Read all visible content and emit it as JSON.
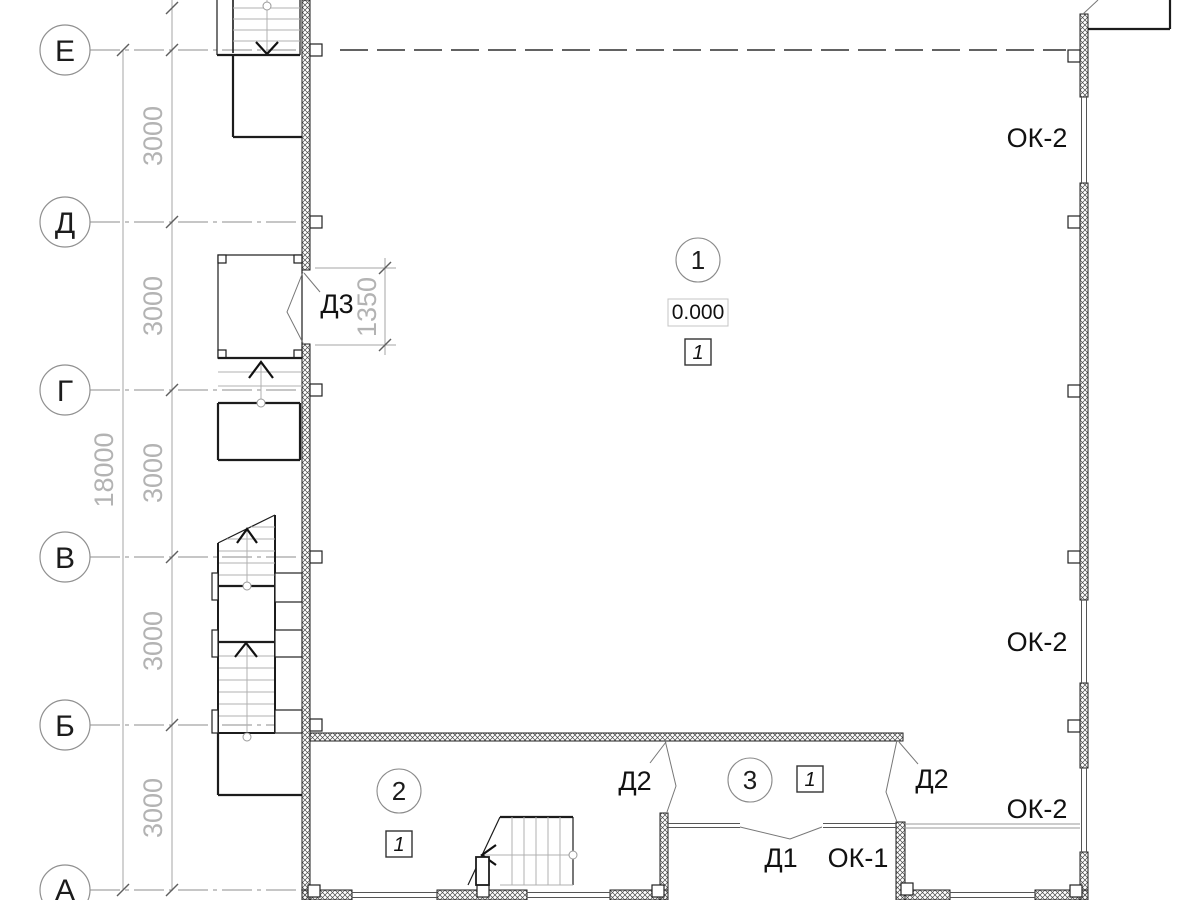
{
  "drawing": {
    "type": "architectural-floor-plan",
    "axes": {
      "e": "Е",
      "d": "Д",
      "g": "Г",
      "v": "В",
      "b": "Б",
      "a": "А"
    },
    "dims": {
      "total": "18000",
      "s1": "3000",
      "s2": "3000",
      "s3": "3000",
      "s4": "3000",
      "s5": "3000",
      "door": "1350"
    },
    "rooms": {
      "r1": {
        "num": "1",
        "elevation": "0.000",
        "mark": "1"
      },
      "r2": {
        "num": "2",
        "mark": "1"
      },
      "r3": {
        "num": "3",
        "mark": "1"
      }
    },
    "openings": {
      "d3": "Д3",
      "d2_left": "Д2",
      "d2_right": "Д2",
      "d1": "Д1",
      "ok1": "ОК-1",
      "ok2_top": "ОК-2",
      "ok2_mid": "ОК-2",
      "ok2_bot": "ОК-2"
    },
    "colors": {
      "line": "#1c1c1c",
      "dim_line": "#a6a6a6",
      "dim_text": "#b3b3b3",
      "tread": "#b0b0b0",
      "hatch": "#4a4a4a"
    }
  }
}
